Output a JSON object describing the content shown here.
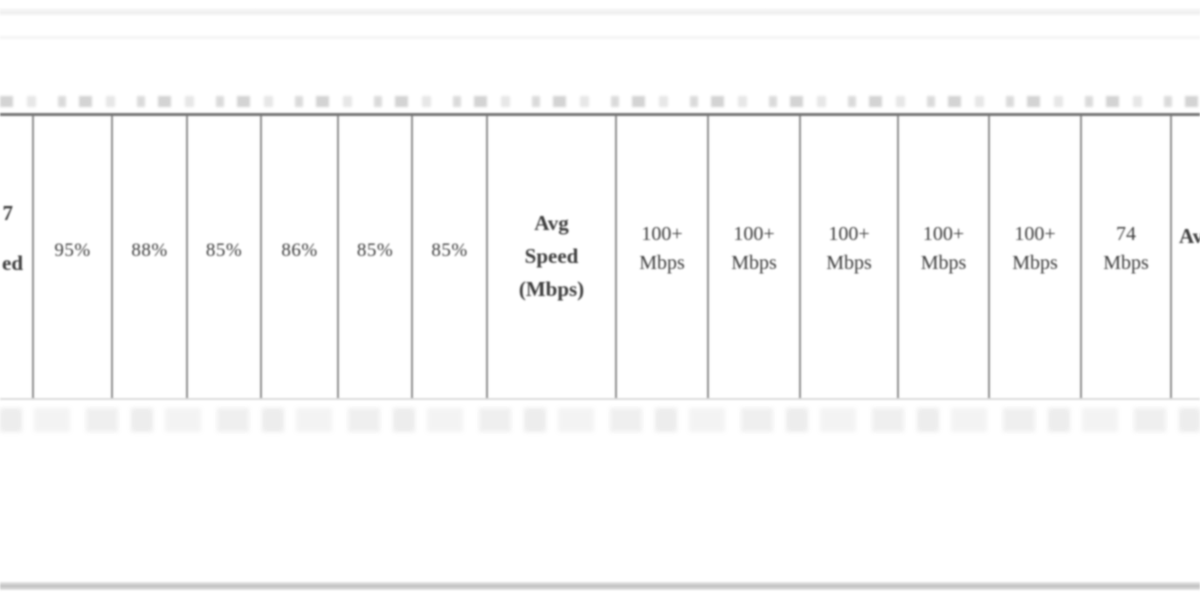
{
  "table": {
    "left_partial_header": {
      "line1": "7",
      "line2": "ed"
    },
    "percent_values": [
      "95%",
      "88%",
      "85%",
      "86%",
      "85%",
      "85%"
    ],
    "avg_speed_header": {
      "line1": "Avg",
      "line2": "Speed",
      "line3": "(Mbps)"
    },
    "speed_values": [
      {
        "line1": "100+",
        "line2": "Mbps"
      },
      {
        "line1": "100+",
        "line2": "Mbps"
      },
      {
        "line1": "100+",
        "line2": "Mbps"
      },
      {
        "line1": "100+",
        "line2": "Mbps"
      },
      {
        "line1": "100+",
        "line2": "Mbps"
      },
      {
        "line1": "74",
        "line2": "Mbps"
      }
    ],
    "right_partial_header": "Av"
  },
  "colors": {
    "background": "#ffffff",
    "table_top_border": "#757575",
    "cell_border": "#8f8f8f",
    "table_bottom_border": "#dcdcdc",
    "text": "#3d3d3d",
    "bottom_rule": "#bfbfbf"
  }
}
